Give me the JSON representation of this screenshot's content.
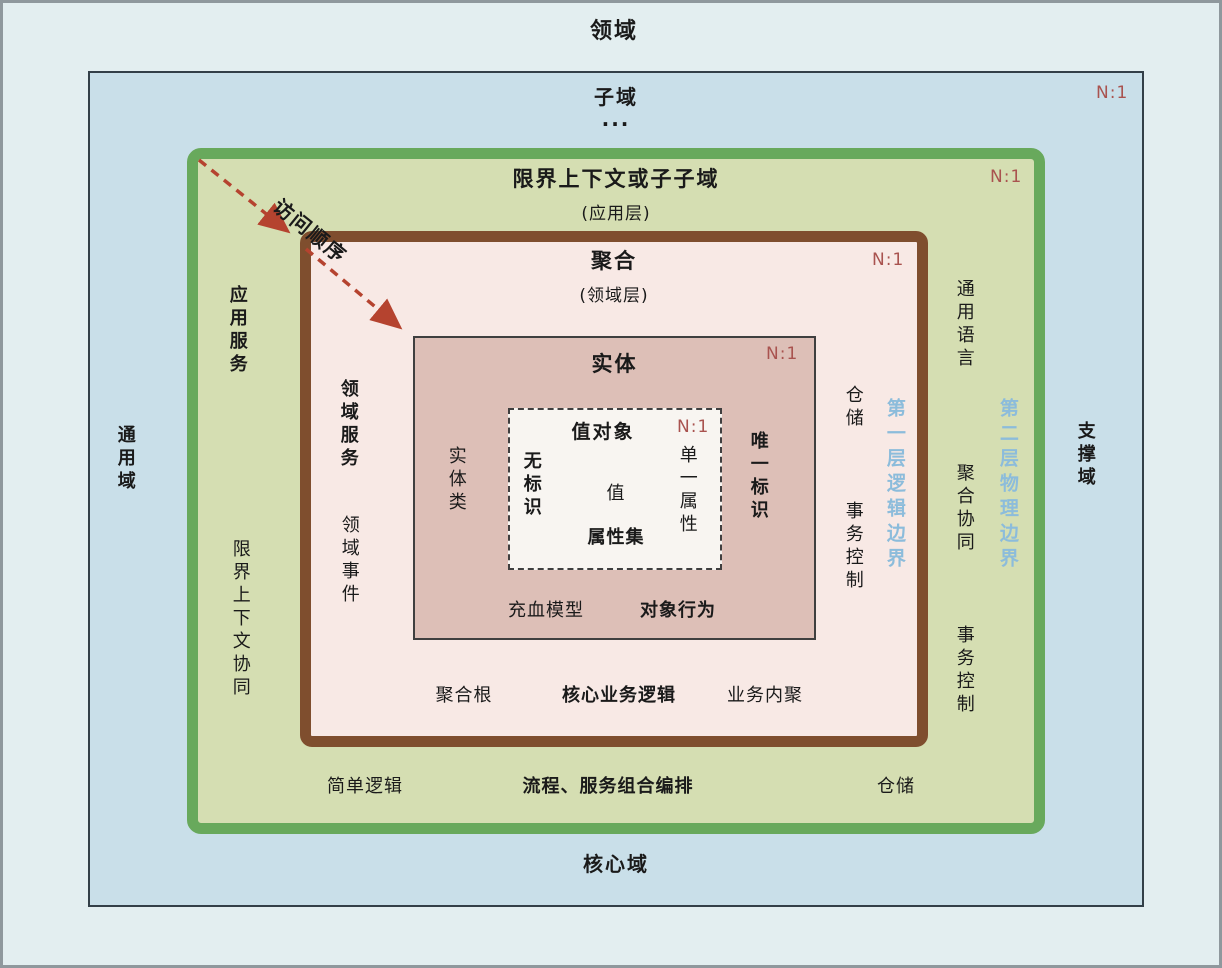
{
  "colors": {
    "outer_bg": "#e3eef0",
    "subdomain_bg": "#c9dfe9",
    "context_bg": "#d5deb2",
    "context_border": "#68a95c",
    "aggregate_bg": "#f8e9e5",
    "aggregate_border": "#7f4e2e",
    "entity_bg": "#ddbfb7",
    "value_object_bg": "#f8f5f1",
    "n1_red": "#a9534f",
    "boundary_blue": "#8cbcdb",
    "arrow_red": "#b5432f"
  },
  "domain": {
    "title": "领域"
  },
  "subdomain": {
    "title": "子域",
    "ellipsis": "...",
    "n1": "N:1",
    "left": "通用域",
    "right": "支撑域",
    "bottom": "核心域"
  },
  "context": {
    "title": "限界上下文或子子域",
    "subtitle": "(应用层)",
    "n1": "N:1",
    "left_top": "应用服务",
    "left_bottom": "限界上下文协同",
    "right_top": "通用语言",
    "right_middle": "聚合协同",
    "right_bottom": "事务控制",
    "boundary": "第二层物理边界",
    "bottom_left": "简单逻辑",
    "bottom_center": "流程、服务组合编排",
    "bottom_right": "仓储"
  },
  "aggregate": {
    "title": "聚合",
    "subtitle": "(领域层)",
    "n1": "N:1",
    "left_top": "领域服务",
    "left_bottom": "领域事件",
    "right_top": "仓储",
    "right_bottom": "事务控制",
    "boundary": "第一层逻辑边界",
    "bottom_left": "聚合根",
    "bottom_center": "核心业务逻辑",
    "bottom_right": "业务内聚"
  },
  "entity": {
    "title": "实体",
    "n1": "N:1",
    "left": "实体类",
    "right": "唯一标识",
    "bottom_left": "充血模型",
    "bottom_right": "对象行为"
  },
  "value_object": {
    "title": "值对象",
    "n1": "N:1",
    "left": "无标识",
    "center": "值",
    "bottom": "属性集",
    "right": "单一属性"
  },
  "arrow": {
    "label": "访问顺序"
  }
}
